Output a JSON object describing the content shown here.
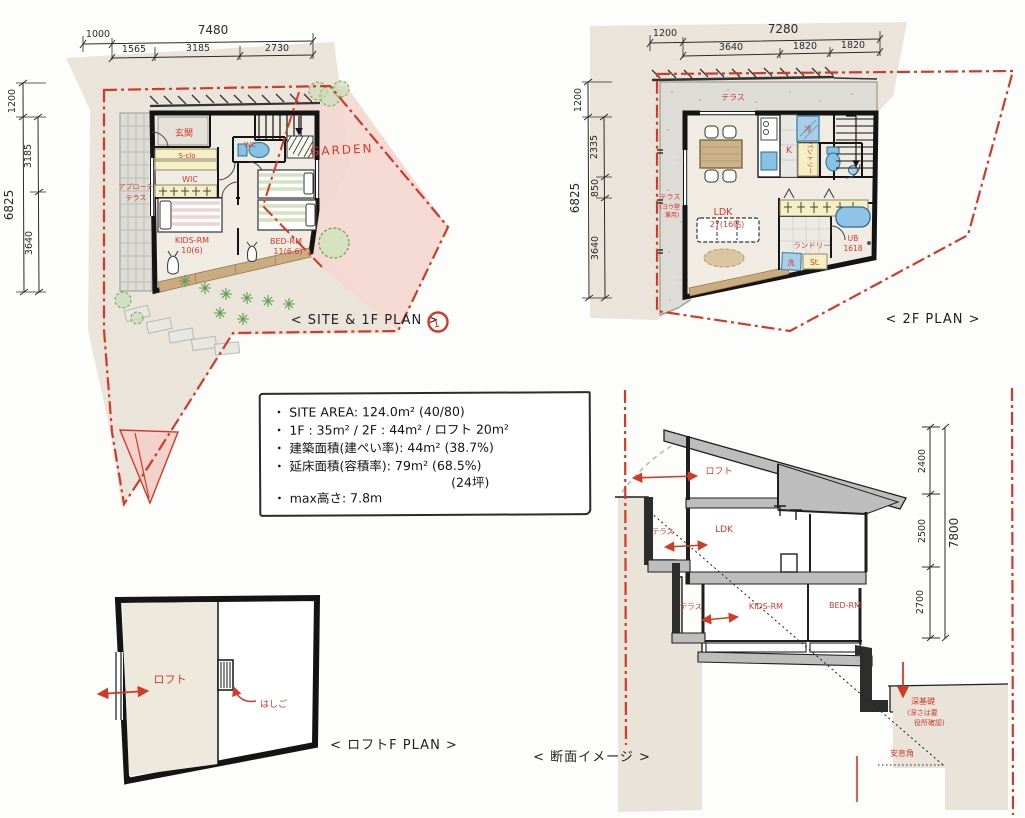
{
  "plan1f": {
    "caption": "< SITE & 1F PLAN >",
    "marker": "1",
    "garden_label": "GARDEN",
    "rooms": {
      "genkan": "玄関",
      "sclo": "S-clo",
      "wic": "WIC",
      "wc": "WC",
      "approach": "アプローチ",
      "terrace": "テラス",
      "kids_rm": "KIDS-RM",
      "kids_area": "10(6)",
      "bed_rm": "BED-RM",
      "bed_area": "11(6.6)"
    },
    "dims": {
      "top_offset": "1000",
      "top_total": "7480",
      "top_s1": "1565",
      "top_s2": "3185",
      "top_s3": "2730",
      "left_offset": "1200",
      "left_total": "6825",
      "left_s1": "3185",
      "left_s2": "3640"
    }
  },
  "plan2f": {
    "caption": "< 2F PLAN >",
    "rooms": {
      "terrace_top": "テラス",
      "terrace_side": "テラス",
      "terrace_note1": "(ヨウ壁",
      "terrace_note2": "兼用)",
      "ldk": "LDK",
      "ldk_area": "27(16帖)",
      "kitchen": "K",
      "fridge": "冷",
      "pantry": "パントリー",
      "laundry": "ランドリー",
      "washer": "洗",
      "storage": "St.",
      "bath": "UB",
      "bath_size": "1618"
    },
    "dims": {
      "top_offset": "1200",
      "top_total": "7280",
      "top_s1": "3640",
      "top_s2": "1820",
      "top_s3": "1820",
      "left_offset": "1200",
      "left_total": "6825",
      "left_s1": "2335",
      "left_s2": "850",
      "left_s3": "3640"
    }
  },
  "notes": {
    "line1": "・ SITE AREA: 124.0m² (40/80)",
    "line2": "・ 1F : 35m² / 2F : 44m² / ロフト 20m²",
    "line3": "・ 建築面積(建ぺい率): 44m² (38.7%)",
    "line4": "・ 延床面積(容積率): 79m² (68.5%)",
    "line5": "(24坪)",
    "line6": "・ max高さ: 7.8m"
  },
  "loft": {
    "caption": "< ロフトF PLAN >",
    "label": "ロフト",
    "ladder_label": "はしご"
  },
  "section": {
    "caption": "< 断面イメージ >",
    "labels": {
      "loft": "ロフト",
      "terrace_2f": "テラス",
      "ldk": "LDK",
      "terrace_1f": "テラス",
      "kids_rm": "KIDS-RM",
      "bed_rm": "BED-RM",
      "foundation": "深基礎",
      "foundation_note1": "(深さは要",
      "foundation_note2": "役所確認)",
      "repose": "安息角"
    },
    "dims": {
      "s1": "2400",
      "s2": "2500",
      "s3": "2700",
      "total": "7800"
    }
  }
}
